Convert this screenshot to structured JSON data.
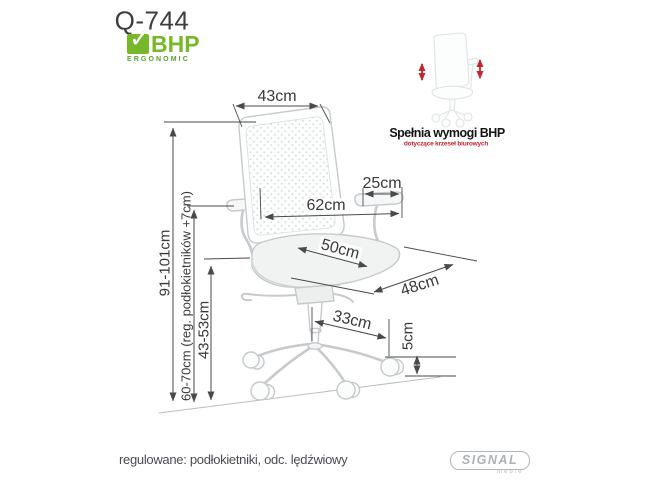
{
  "page": {
    "title": "Q-744",
    "footer_note": "regulowane: podłokietniki, odc. lędźwiowy"
  },
  "bhp_logo": {
    "check": "✓",
    "name": "BHP",
    "subtitle": "ERGONOMIC",
    "green": "#76b82a"
  },
  "compliance": {
    "heading": "Spełnia wymogi BHP",
    "subheading": "dotyczące krzeseł biurowych",
    "arrow_color": "#c1272d"
  },
  "brand": {
    "name": "SIGNAL",
    "subname": "meble"
  },
  "dimensions": {
    "back_width": "43cm",
    "total_height": "91-101cm",
    "armrest_height": "60-70cm (reg. podłokietników +7cm)",
    "seat_height": "43-53cm",
    "armrest_pad_length": "25cm",
    "total_depth": "62cm",
    "seat_depth": "50cm",
    "seat_width": "48cm",
    "base_leg_reach": "33cm",
    "caster_height": "5cm"
  }
}
